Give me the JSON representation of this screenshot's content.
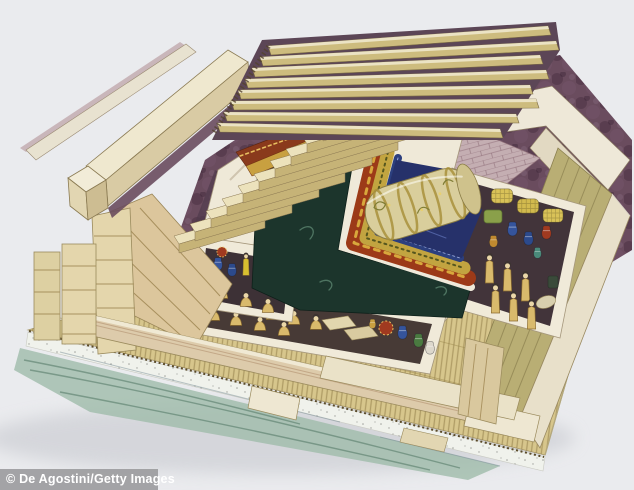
{
  "image": {
    "title": "Cutaway reconstruction illustration of an ancient Chinese tomb",
    "description": "Isometric cutaway artwork of a timber burial pit: stepped entrance stairway and wooden roof beams above purple rammed-earth fill, cream chamber walls, nested lacquered coffins holding a silk-wrapped body, side compartments filled with tomb figurines, jars and woven bales, all resting on a bamboo-mat platform above white-clay and charcoal layers.",
    "background_color": "#eaebee"
  },
  "watermark": {
    "text": "© De Agostini/Getty Images",
    "bar_color": "#969699",
    "text_color": "#ffffff"
  },
  "palette": {
    "wood_beam": "#cdbc7e",
    "wood_top": "#efe8cc",
    "wall_cream": "#efe9d8",
    "plank_tan": "#dcc69c",
    "earth_purple": "#6a4c5e",
    "earth_dark": "#5c4656",
    "brick_mauve": "#c4aeb2",
    "coffin_dark": "#1c352c",
    "coffin_red": "#9c3a18",
    "coffin_gold": "#c2a440",
    "coffin_blue": "#2c3f7e",
    "body_wrap": "#d9ce9c",
    "figurine_tan": "#d9ba6c",
    "mat_floor": "#d7c68c",
    "clay_white": "#f0f2ec",
    "charcoal_green": "#9fbcaa",
    "wall_olive": "#b9ae74"
  }
}
